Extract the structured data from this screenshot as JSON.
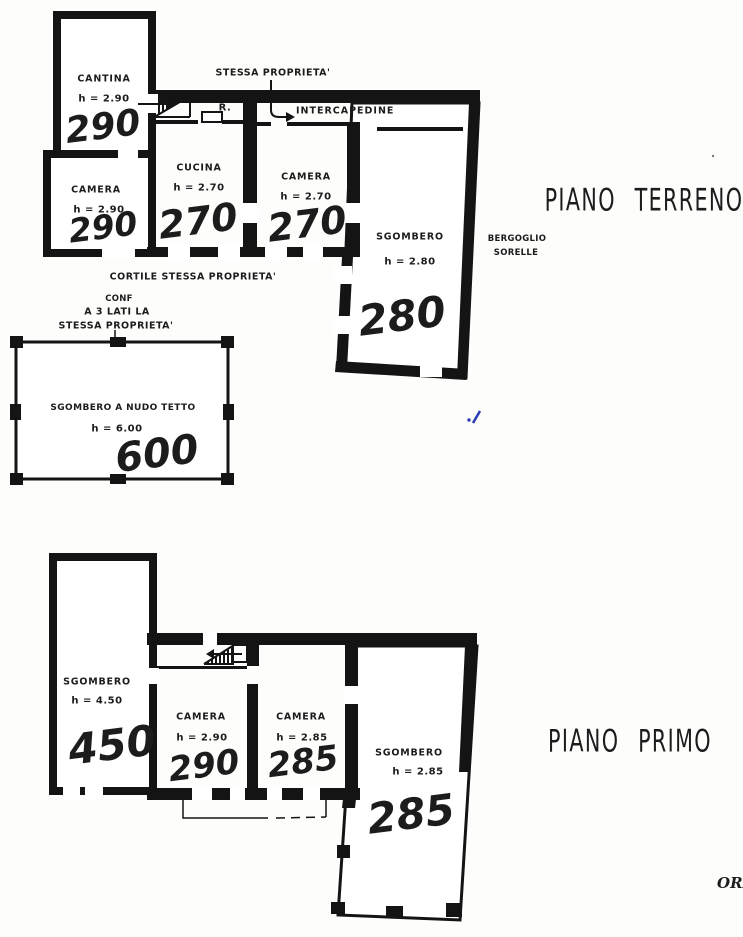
{
  "document": {
    "type": "scanned floor plan",
    "corner_text": "ORI"
  },
  "colors": {
    "ink": "#141414",
    "paper": "#fdfdfc",
    "annotation_blue": "#2a3bb5"
  },
  "ground_floor": {
    "title": "PIANO TERRENO",
    "neighbor_line1": "BERGOGLIO",
    "neighbor_line2": "SORELLE",
    "boundary_note": "STESSA PROPRIETA'",
    "intercapedine_label": "INTERCAPEDINE",
    "stair_label": "R.",
    "courtyard_note": "CORTILE STESSA PROPRIETA'",
    "confine_note_line1": "CONF",
    "confine_note_line2": "A 3 LATI LA",
    "confine_note_line3": "STESSA PROPRIETA'",
    "rooms": {
      "cantina": {
        "name": "CANTINA",
        "height": "h = 2.90",
        "scrawled_value": "290"
      },
      "camera1": {
        "name": "CAMERA",
        "height": "h = 2.90",
        "scrawled_value": "290"
      },
      "cucina": {
        "name": "CUCINA",
        "height": "h = 2.70",
        "scrawled_value": "270"
      },
      "camera2": {
        "name": "CAMERA",
        "height": "h = 2.70",
        "scrawled_value": "270"
      },
      "sgombero": {
        "name": "SGOMBERO",
        "height": "h = 2.80",
        "scrawled_value": "280"
      },
      "sgombero_nudo_tetto": {
        "name": "SGOMBERO A NUDO TETTO",
        "height": "h = 6.00",
        "scrawled_value": "600"
      }
    }
  },
  "first_floor": {
    "title": "PIANO PRIMO",
    "rooms": {
      "sgombero_left": {
        "name": "SGOMBERO",
        "height": "h = 4.50",
        "scrawled_value": "450"
      },
      "camera1": {
        "name": "CAMERA",
        "height": "h = 2.90",
        "scrawled_value": "290"
      },
      "camera2": {
        "name": "CAMERA",
        "height": "h = 2.85",
        "scrawled_value": "285"
      },
      "sgombero_right": {
        "name": "SGOMBERO",
        "height": "h = 2.85",
        "scrawled_value": "285"
      }
    }
  }
}
